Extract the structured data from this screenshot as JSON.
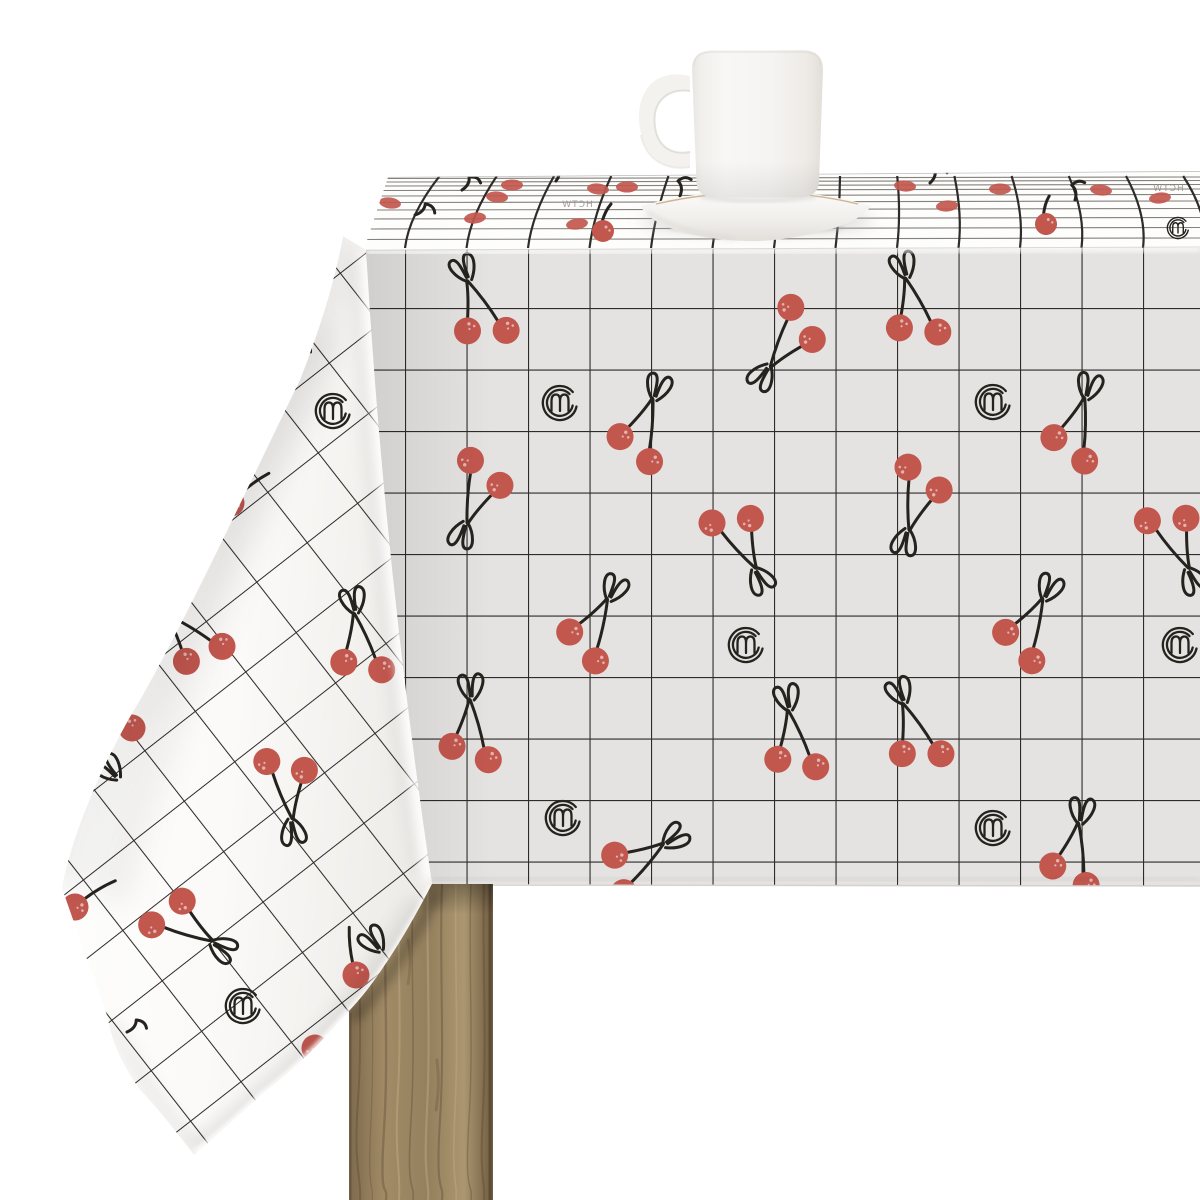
{
  "scene": {
    "type": "product-photo",
    "subject": "White tablecloth with black windowpane grid and red cherry pattern, white mug on saucer, wooden table leg",
    "objects": {
      "mug": "white ceramic mug",
      "saucer": "white saucer with thin tan rim line",
      "tablecloth": "white coated-fabric tablecloth with black grid, red cherries and small brand logo stamps",
      "table_leg": "natural wood table leg",
      "logo_glyph": "m",
      "brand_text": "HCTW"
    }
  },
  "colors": {
    "background": "#ffffff",
    "cherry": "#c2574e",
    "cherry_speckle": "#ffffff",
    "line": "#26231f",
    "grid": "#2e2b29",
    "cloth_front": "#e4e3e1",
    "cloth_top": "#fdfdfc",
    "cloth_drape": "#fbfaf9",
    "wood_base": "#9c8764",
    "wood_dark": "#5f4c34",
    "wood_light": "#c9b591",
    "china": "#f5f3f0",
    "china_shadow": "#dcd8d3",
    "saucer_line": "#c7a87f",
    "shadow": "#b7b3ae"
  },
  "pattern": {
    "front": {
      "grid_size": 61.5,
      "items": [
        {
          "s": "pair",
          "x": 484,
          "y": 321,
          "r": -22
        },
        {
          "s": "pair",
          "x": 639,
          "y": 440,
          "r": 19
        },
        {
          "s": "pair",
          "x": 795,
          "y": 331,
          "r": -145
        },
        {
          "s": "pair",
          "x": 917,
          "y": 320,
          "r": -15
        },
        {
          "s": "pair",
          "x": 1073,
          "y": 440,
          "r": 16
        },
        {
          "s": "pair",
          "x": 920,
          "y": 488,
          "r": -165
        },
        {
          "s": "pair",
          "x": 735,
          "y": 530,
          "r": 152
        },
        {
          "s": "pair",
          "x": 588,
          "y": 638,
          "r": 27
        },
        {
          "s": "pair",
          "x": 1024,
          "y": 638,
          "r": 26
        },
        {
          "s": "pair",
          "x": 1170,
          "y": 529,
          "r": 155
        },
        {
          "s": "pair",
          "x": 919,
          "y": 744,
          "r": -21
        },
        {
          "s": "pair",
          "x": 796,
          "y": 753,
          "r": -10
        },
        {
          "s": "pair",
          "x": 1072,
          "y": 866,
          "r": 9
        },
        {
          "s": "pair",
          "x": 481,
          "y": 482,
          "r": -161
        },
        {
          "s": "pair",
          "x": 471,
          "y": 743,
          "r": -1
        },
        {
          "s": "pair",
          "x": 628,
          "y": 869,
          "r": 55
        },
        {
          "s": "logo",
          "x": 560,
          "y": 403
        },
        {
          "s": "logo",
          "x": 993,
          "y": 402
        },
        {
          "s": "logo",
          "x": 746,
          "y": 645
        },
        {
          "s": "logo",
          "x": 1180,
          "y": 645
        },
        {
          "s": "logo",
          "x": 993,
          "y": 828
        },
        {
          "s": "logo",
          "x": 563,
          "y": 818
        }
      ]
    },
    "drape": {
      "grid_size": 64,
      "grid_angle": -38,
      "items": [
        {
          "s": "bow",
          "x": 305,
          "y": 350,
          "r": -40
        },
        {
          "s": "logo",
          "x": 333,
          "y": 411
        },
        {
          "s": "berrystem",
          "x": 231,
          "y": 503,
          "r": 35
        },
        {
          "s": "pair",
          "x": 198,
          "y": 646,
          "r": -44
        },
        {
          "s": "pair",
          "x": 362,
          "y": 656,
          "r": -10
        },
        {
          "s": "berrystem",
          "x": 132,
          "y": 728,
          "r": -55
        },
        {
          "s": "bow",
          "x": 115,
          "y": 775,
          "r": -40
        },
        {
          "s": "pair",
          "x": 286,
          "y": 776,
          "r": 172
        },
        {
          "s": "berrystem",
          "x": 75,
          "y": 907,
          "r": 40
        },
        {
          "s": "pair",
          "x": 175,
          "y": 919,
          "r": 121
        },
        {
          "s": "logo",
          "x": 243,
          "y": 1006
        },
        {
          "s": "berrystem",
          "x": 315,
          "y": 1048,
          "r": 170
        },
        {
          "s": "bow",
          "x": 378,
          "y": 947,
          "r": -35
        },
        {
          "s": "berrystem",
          "x": 356,
          "y": 975,
          "r": -25
        },
        {
          "s": "tstem",
          "x": 127,
          "y": 1032,
          "r": 30
        }
      ]
    },
    "top_band": {
      "items": [
        {
          "s": "blob",
          "x": 390,
          "y": 203,
          "r": 8
        },
        {
          "s": "blob",
          "x": 475,
          "y": 218,
          "r": -6
        },
        {
          "s": "blob",
          "x": 497,
          "y": 197,
          "r": 5
        },
        {
          "s": "blob",
          "x": 512,
          "y": 185,
          "r": 0
        },
        {
          "s": "blob",
          "x": 577,
          "y": 224,
          "r": -8
        },
        {
          "s": "blob",
          "x": 598,
          "y": 189,
          "r": 6
        },
        {
          "s": "blob",
          "x": 627,
          "y": 187,
          "r": 0
        },
        {
          "s": "blob",
          "x": 905,
          "y": 186,
          "r": 5
        },
        {
          "s": "blob",
          "x": 947,
          "y": 206,
          "r": -5
        },
        {
          "s": "blob",
          "x": 1000,
          "y": 189,
          "r": 0
        },
        {
          "s": "blob",
          "x": 1101,
          "y": 190,
          "r": 7
        },
        {
          "s": "blob",
          "x": 1160,
          "y": 198,
          "r": -6
        },
        {
          "s": "hang",
          "x": 603,
          "y": 231,
          "r": 0
        },
        {
          "s": "hang",
          "x": 1046,
          "y": 224,
          "r": -10
        },
        {
          "s": "tstem",
          "x": 462,
          "y": 190,
          "r": 20
        },
        {
          "s": "tstem",
          "x": 556,
          "y": 181,
          "r": 0
        },
        {
          "s": "tstem",
          "x": 680,
          "y": 196,
          "r": -15
        },
        {
          "s": "tstem",
          "x": 930,
          "y": 183,
          "r": 10
        },
        {
          "s": "tstem",
          "x": 1075,
          "y": 200,
          "r": -20
        },
        {
          "s": "tstem",
          "x": 415,
          "y": 215,
          "r": 35
        },
        {
          "s": "logo",
          "x": 1178,
          "y": 228,
          "sc": 0.62
        }
      ],
      "texts": [
        {
          "v": "HCTW",
          "x": 577,
          "y": 207
        },
        {
          "v": "HCTW",
          "x": 1168,
          "y": 191
        }
      ]
    }
  }
}
